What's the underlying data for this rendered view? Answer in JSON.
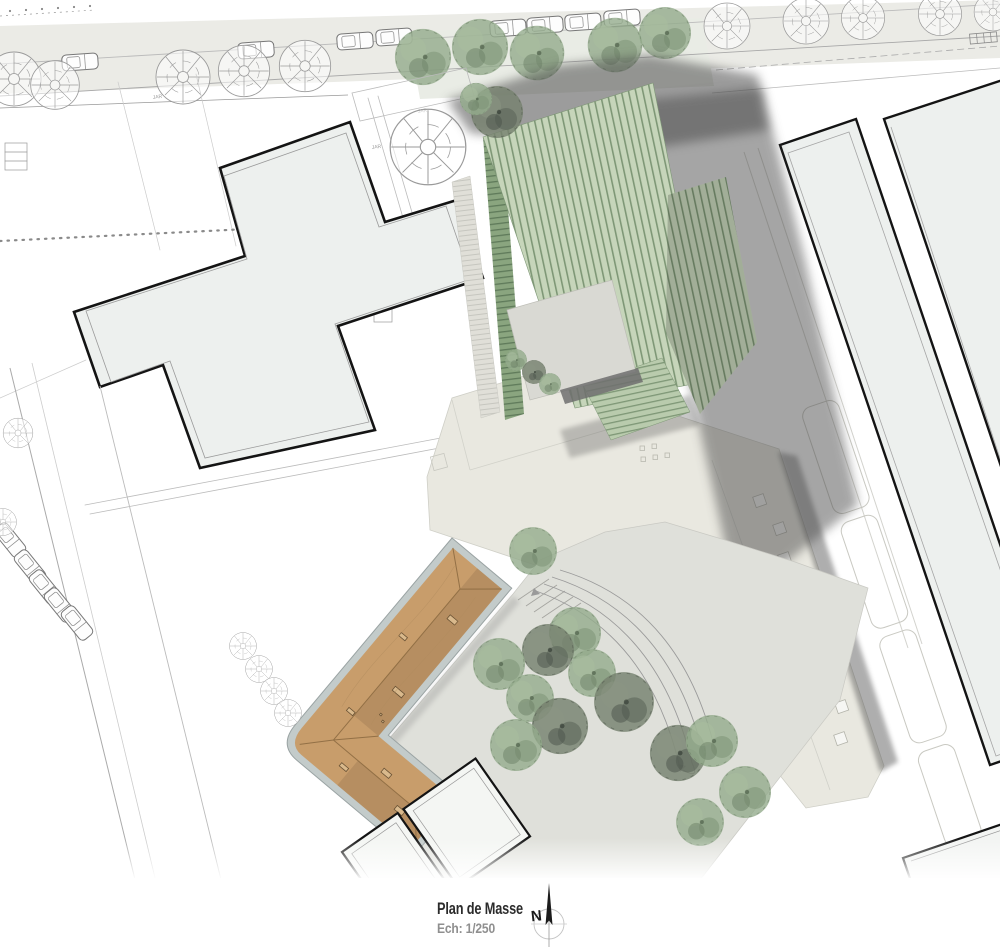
{
  "titleblock": {
    "title": "Plan de Masse",
    "scale": "Ech: 1/250"
  },
  "north": {
    "letter": "N"
  },
  "labels": {
    "garden": "JAR"
  },
  "colors": {
    "roof_green": "#c6d5ba",
    "roof_green_line": "#7e9776",
    "roof_green_dark": "#8aa57f",
    "roof_green_dark_line": "#5f7a5a",
    "roof_green_cross": "#b9cbad",
    "roof_brown": "#c89d6b",
    "wall_gray": "#c3cbca",
    "shadow": "#4d4d4d",
    "plaza": "#dfe0da",
    "terrace": "#e9e8e0",
    "courtyard": "#d9d9d3",
    "building_fill": "#edf0ee",
    "outline": "#141414",
    "tree_green": "#93ab8c",
    "tree_dark": "#76816f",
    "walkway": "#e0dfd8",
    "walkway_line": "#c6c6bf",
    "title_color": "#2b2b2b",
    "scale_color": "#8f8f8f"
  }
}
